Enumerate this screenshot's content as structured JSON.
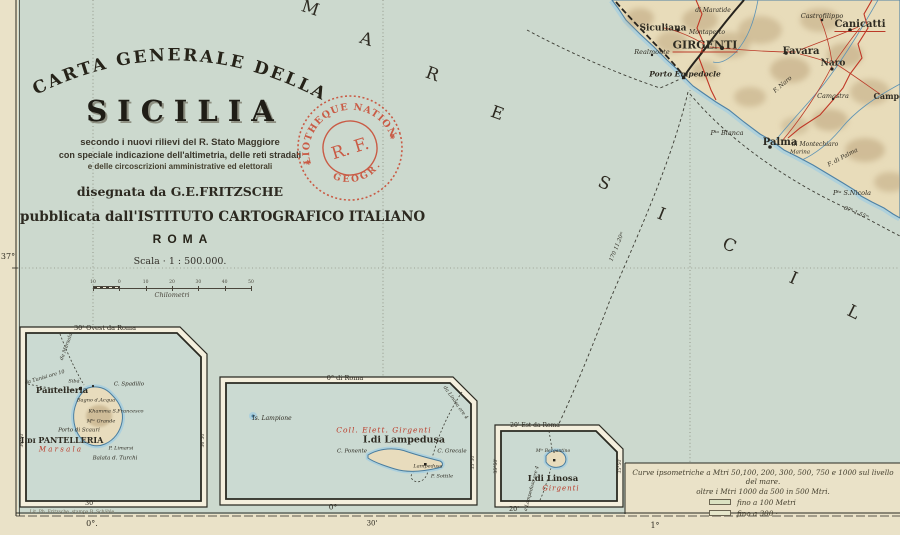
{
  "title_block": {
    "arc": "CARTA GENERALE DELLA",
    "main": "SICILIA",
    "sub1": "secondo i nuovi rilievi del R. Stato Maggiore",
    "sub2": "con speciale indicazione dell'altimetria, delle reti stradali",
    "sub3": "e delle circoscrizioni amministrative ed elettorali",
    "author": "disegnata da G.E.FRITZSCHE",
    "publisher": "pubblicata dall'ISTITUTO CARTOGRAFICO ITALIANO",
    "city": "ROMA",
    "scale": "Scala · 1 : 500.000.",
    "scale_unit": "Chilometri",
    "scale_ticks": [
      "10",
      "0",
      "10",
      "20",
      "30",
      "40",
      "50"
    ]
  },
  "stamp": {
    "top": "BIBLIOTHEQUE NATIONALE",
    "center": "R. F.",
    "bottom": "GEOGR."
  },
  "legend": {
    "line1": "Curve ipsometriche a Mtri 50,100, 200, 300, 500, 750 e 1000 sul livello del mare.",
    "line2": "oltre i Mtri 1000 da 500 in 500 Mtri.",
    "items": [
      {
        "label": "fino a 100 Metri",
        "color": "#dbe2c2"
      },
      {
        "label": "fino a 300   ·",
        "color": "#e6e7cb"
      }
    ]
  },
  "colors": {
    "paper": "#eae2c8",
    "sea": "#cfdbd0",
    "land": "#e8dcba",
    "accent_red": "#bb3a28",
    "stamp_red": "#c9523b",
    "coast_blue": "#4e81a4"
  },
  "labels": [
    {
      "t": "M",
      "x": 310,
      "y": 9,
      "s": 17,
      "rot": 18,
      "n": "sea-letter"
    },
    {
      "t": "A",
      "x": 366,
      "y": 40,
      "s": 17,
      "rot": 18,
      "n": "sea-letter"
    },
    {
      "t": "R",
      "x": 432,
      "y": 75,
      "s": 17,
      "rot": 20,
      "n": "sea-letter"
    },
    {
      "t": "E",
      "x": 497,
      "y": 114,
      "s": 17,
      "rot": 20,
      "n": "sea-letter"
    },
    {
      "t": "S",
      "x": 604,
      "y": 184,
      "s": 17,
      "rot": 22,
      "n": "sea-letter"
    },
    {
      "t": "I",
      "x": 661,
      "y": 215,
      "s": 17,
      "rot": 22,
      "n": "sea-letter"
    },
    {
      "t": "C",
      "x": 729,
      "y": 246,
      "s": 17,
      "rot": 24,
      "n": "sea-letter"
    },
    {
      "t": "I",
      "x": 793,
      "y": 279,
      "s": 17,
      "rot": 24,
      "n": "sea-letter"
    },
    {
      "t": "L",
      "x": 853,
      "y": 313,
      "s": 17,
      "rot": 26,
      "n": "sea-letter"
    },
    {
      "t": "Siculiana",
      "x": 663,
      "y": 29,
      "s": 9,
      "b": 1,
      "n": "label-siculiana"
    },
    {
      "t": "GIRGENTI",
      "x": 705,
      "y": 46,
      "s": 11,
      "b": 1,
      "u": 1,
      "n": "label-girgenti"
    },
    {
      "t": "Favara",
      "x": 801,
      "y": 52,
      "s": 10,
      "b": 1,
      "n": "label-favara"
    },
    {
      "t": "Canicatti",
      "x": 860,
      "y": 26,
      "s": 10,
      "b": 1,
      "u": 1,
      "n": "label-canicatti"
    },
    {
      "t": "Naro",
      "x": 833,
      "y": 64,
      "s": 9,
      "b": 1,
      "n": "label-naro"
    },
    {
      "t": "Castrofilippo",
      "x": 822,
      "y": 16,
      "s": 6.5,
      "it": 1,
      "n": "label-castrofilippo"
    },
    {
      "t": "Realmonte",
      "x": 652,
      "y": 52,
      "s": 6.5,
      "it": 1,
      "n": "label-realmonte"
    },
    {
      "t": "Porto Empedocle",
      "x": 685,
      "y": 74,
      "s": 7.5,
      "it": 1,
      "b": 1,
      "n": "label-porto-empedocle"
    },
    {
      "t": "Montaperto",
      "x": 707,
      "y": 33,
      "s": 6,
      "it": 1
    },
    {
      "t": "di Maratide",
      "x": 713,
      "y": 11,
      "s": 6,
      "it": 1
    },
    {
      "t": "Camastra",
      "x": 833,
      "y": 96,
      "s": 6.5,
      "it": 1,
      "n": "label-camastra"
    },
    {
      "t": "Campo",
      "x": 889,
      "y": 96,
      "s": 8,
      "b": 1,
      "n": "label-campobello"
    },
    {
      "t": "Palma",
      "x": 780,
      "y": 143,
      "s": 10,
      "b": 1,
      "n": "label-palma"
    },
    {
      "t": "di Montechiaro",
      "x": 815,
      "y": 145,
      "s": 6,
      "it": 1
    },
    {
      "t": "Marina",
      "x": 800,
      "y": 153,
      "s": 5.5,
      "it": 1
    },
    {
      "t": "Pᵗᵃ Bianca",
      "x": 727,
      "y": 133,
      "s": 6.5,
      "it": 1,
      "n": "label-punta-bianca"
    },
    {
      "t": "Pᵗᵃ S.Nicola",
      "x": 852,
      "y": 193,
      "s": 6.5,
      "it": 1,
      "n": "label-punta-s-nicola"
    },
    {
      "t": "F. Naro",
      "x": 783,
      "y": 85,
      "s": 6,
      "it": 1,
      "rot": -40
    },
    {
      "t": "F. di Palma",
      "x": 843,
      "y": 158,
      "s": 6,
      "it": 1,
      "rot": -28
    },
    {
      "t": "170  11.20ᵐ",
      "x": 618,
      "y": 247,
      "s": 5.5,
      "it": 1,
      "rot": -68,
      "n": "route-label"
    },
    {
      "t": "87ᵏ  1.55ᵐ",
      "x": 856,
      "y": 214,
      "s": 5.5,
      "it": 1,
      "rot": 22,
      "n": "route-label"
    },
    {
      "t": "37°",
      "x": 8,
      "y": 257,
      "s": 8,
      "n": "margin-latitude"
    },
    {
      "t": "0°.",
      "x": 92,
      "y": 524,
      "s": 8,
      "n": "margin-longitude"
    },
    {
      "t": "30'",
      "x": 372,
      "y": 524,
      "s": 7,
      "n": "margin-longitude"
    },
    {
      "t": "1°",
      "x": 655,
      "y": 526,
      "s": 8,
      "n": "margin-longitude"
    },
    {
      "t": "Lit. Ph. Fritzsche, stampa B. Schäble",
      "x": 72,
      "y": 513,
      "s": 4.5,
      "c": "#6b6552",
      "n": "imprint"
    },
    {
      "t": "30' Ovest da Roma",
      "x": 105,
      "y": 328,
      "s": 6.5,
      "n": "inset-pantelleria-meridian"
    },
    {
      "t": "30'",
      "x": 90,
      "y": 503,
      "s": 6.5
    },
    {
      "t": "36°50'",
      "x": 23,
      "y": 440,
      "s": 4.5,
      "rot": -90
    },
    {
      "t": "36°50'",
      "x": 204,
      "y": 440,
      "s": 4.5,
      "rot": -90
    },
    {
      "t": "da Marsala",
      "x": 67,
      "y": 347,
      "s": 5,
      "it": 1,
      "rot": -70
    },
    {
      "t": "da Tunisi ore 10",
      "x": 45,
      "y": 378,
      "s": 5,
      "it": 1,
      "rot": -16
    },
    {
      "t": "Pantelleria",
      "x": 62,
      "y": 391,
      "s": 8.5,
      "b": 1,
      "n": "label-pantelleria-town"
    },
    {
      "t": "Sibà",
      "x": 74,
      "y": 382,
      "s": 5,
      "it": 1
    },
    {
      "t": "C. Spadillo",
      "x": 129,
      "y": 385,
      "s": 5.5,
      "it": 1
    },
    {
      "t": "Bagno d.Acqua",
      "x": 96,
      "y": 401,
      "s": 5,
      "it": 1
    },
    {
      "t": "Khamma S.Francesco",
      "x": 116,
      "y": 412,
      "s": 5,
      "it": 1
    },
    {
      "t": "Mᵗᵉ Grande",
      "x": 101,
      "y": 422,
      "s": 5,
      "it": 1
    },
    {
      "t": "Porto di Scauri",
      "x": 79,
      "y": 431,
      "s": 5.5,
      "it": 1
    },
    {
      "t": "P. Limarsi",
      "x": 121,
      "y": 449,
      "s": 5,
      "it": 1
    },
    {
      "t": "Balata d. Turchi",
      "x": 115,
      "y": 459,
      "s": 5.5,
      "it": 1
    },
    {
      "t": "I.ᴅɪ PANTELLERIA",
      "x": 62,
      "y": 440,
      "s": 8,
      "b": 1,
      "n": "label-isola-pantelleria"
    },
    {
      "t": "M a r s a l a",
      "x": 60,
      "y": 450,
      "s": 7,
      "it": 1,
      "red": 1,
      "n": "label-coll-elett-marsala"
    },
    {
      "t": "0° di Roma",
      "x": 345,
      "y": 378,
      "s": 6.5,
      "n": "inset-lampedusa-meridian"
    },
    {
      "t": "0°",
      "x": 333,
      "y": 507,
      "s": 7.5
    },
    {
      "t": "35°30'",
      "x": 474,
      "y": 462,
      "s": 4.5,
      "rot": -90
    },
    {
      "t": "Is. Lampione",
      "x": 272,
      "y": 419,
      "s": 6,
      "it": 1,
      "n": "label-lampione"
    },
    {
      "t": "Coll. Elett. Girgenti",
      "x": 384,
      "y": 430,
      "s": 7.5,
      "it": 1,
      "red": 1,
      "ls": 1,
      "n": "label-coll-elett-girgenti"
    },
    {
      "t": "I.di Lampedusa",
      "x": 404,
      "y": 440,
      "s": 9.5,
      "b": 1,
      "n": "label-isola-lampedusa"
    },
    {
      "t": "C. Ponente",
      "x": 352,
      "y": 452,
      "s": 5.5,
      "it": 1
    },
    {
      "t": "C. Grecale",
      "x": 452,
      "y": 452,
      "s": 5.5,
      "it": 1
    },
    {
      "t": "Lampedusa",
      "x": 428,
      "y": 467,
      "s": 5,
      "it": 1
    },
    {
      "t": "P. Sottile",
      "x": 442,
      "y": 477,
      "s": 5,
      "it": 1
    },
    {
      "t": "da Linosa ore 4",
      "x": 455,
      "y": 403,
      "s": 5,
      "it": 1,
      "rot": 55
    },
    {
      "t": "20' Est da Roma",
      "x": 535,
      "y": 426,
      "s": 6,
      "n": "inset-linosa-meridian"
    },
    {
      "t": "20'",
      "x": 514,
      "y": 509,
      "s": 6.5
    },
    {
      "t": "35°50'",
      "x": 497,
      "y": 466,
      "s": 4.5,
      "rot": -90
    },
    {
      "t": "35°50'",
      "x": 621,
      "y": 466,
      "s": 4.5,
      "rot": -90
    },
    {
      "t": "Mᵗᵉ Bergantino",
      "x": 553,
      "y": 452,
      "s": 4.5,
      "it": 1
    },
    {
      "t": "I.di Linosa",
      "x": 553,
      "y": 479,
      "s": 8.5,
      "b": 1,
      "n": "label-isola-linosa"
    },
    {
      "t": "Girgenti",
      "x": 561,
      "y": 489,
      "s": 7,
      "it": 1,
      "red": 1,
      "ls": 1,
      "n": "label-coll-elett-linosa"
    },
    {
      "t": "a Lampedusa ore 4",
      "x": 533,
      "y": 489,
      "s": 4.8,
      "it": 1,
      "rot": -75
    }
  ]
}
